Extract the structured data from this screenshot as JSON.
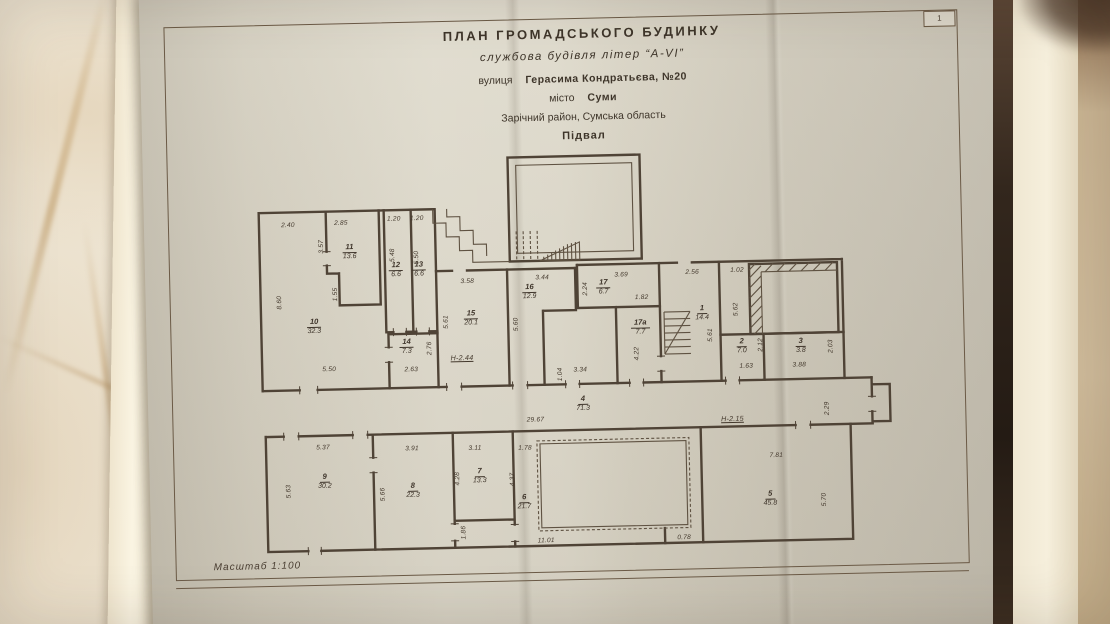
{
  "page": {
    "number": "1"
  },
  "header": {
    "title": "ПЛАН  ГРОМАДСЬКОГО  БУДИНКУ",
    "subtitle": "службова будівля літер “А-VI”",
    "street_label": "вулиця",
    "street_value": "Герасима Кондратьєва, №20",
    "city_label": "місто",
    "city_value": "Суми",
    "district": "Зарічний район, Сумська область",
    "level": "Підвал"
  },
  "footer": {
    "scale": "Масштаб  1:100"
  },
  "colors": {
    "ink": "#4f4336",
    "paper": "#dbd6c7",
    "marble": "#ece2cf"
  },
  "plan": {
    "rooms": [
      {
        "num": "10",
        "area": "32.3"
      },
      {
        "num": "11",
        "area": "13.6"
      },
      {
        "num": "12",
        "area": "6.6"
      },
      {
        "num": "13",
        "area": "6.6"
      },
      {
        "num": "14",
        "area": "7.3"
      },
      {
        "num": "15",
        "area": "20.1"
      },
      {
        "num": "16",
        "area": "12.9"
      },
      {
        "num": "17",
        "area": "6.7"
      },
      {
        "num": "17а",
        "area": "7.7"
      },
      {
        "num": "1",
        "area": "14.4"
      },
      {
        "num": "2",
        "area": "7.0"
      },
      {
        "num": "3",
        "area": "3.8"
      },
      {
        "num": "4",
        "area": "71.3"
      },
      {
        "num": "9",
        "area": "30.2"
      },
      {
        "num": "8",
        "area": "22.3"
      },
      {
        "num": "7",
        "area": "13.3"
      },
      {
        "num": "6",
        "area": "21.7"
      },
      {
        "num": "5",
        "area": "45.8"
      }
    ],
    "dims": [
      "2.40",
      "2.85",
      "3.57",
      "1.20",
      "1.20",
      "5.48",
      "5.50",
      "8.60",
      "1.55",
      "5.50",
      "2.63",
      "2.76",
      "3.58",
      "5.61",
      "Н-2.44",
      "3.44",
      "5.60",
      "1.04",
      "3.34",
      "3.69",
      "2.24",
      "1.82",
      "4.22",
      "2.56",
      "5.61",
      "1.02",
      "5.62",
      "2.12",
      "1.63",
      "3.88",
      "2.03",
      "29.67",
      "Н-2.15",
      "2.29",
      "5.37",
      "3.91",
      "3.11",
      "1.78",
      "5.63",
      "5.66",
      "4.28",
      "4.37",
      "1.86",
      "11.01",
      "0.78",
      "7.81",
      "5.70"
    ]
  }
}
